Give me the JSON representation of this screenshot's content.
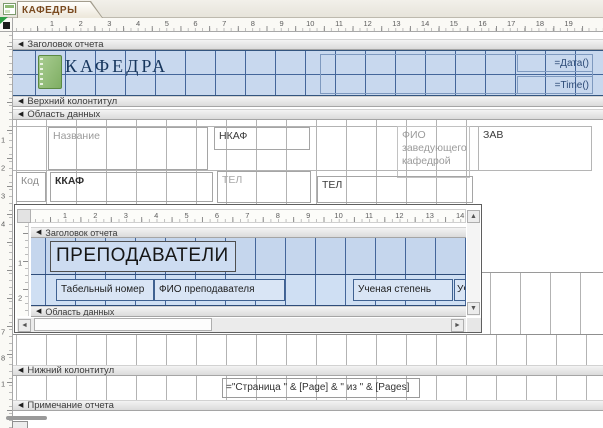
{
  "window": {
    "tab_label": "КАФЕДРЫ"
  },
  "rulers": {
    "main_h": [
      "1",
      "2",
      "3",
      "4",
      "5",
      "6",
      "7",
      "8",
      "9",
      "10",
      "11",
      "12",
      "13",
      "14",
      "15",
      "16",
      "17",
      "18",
      "19"
    ],
    "main_v_upper": [
      "1",
      "2",
      "3",
      "4"
    ],
    "main_v_lower": [
      "7",
      "8",
      "1"
    ],
    "sub_h": [
      "1",
      "2",
      "3",
      "4",
      "5",
      "6",
      "7",
      "8",
      "9",
      "10",
      "11",
      "12",
      "13",
      "14"
    ],
    "sub_v": [
      "1",
      "2"
    ]
  },
  "sections": {
    "report_header": "Заголовок отчета",
    "page_header": "Верхний колонтитул",
    "detail": "Область данных",
    "page_footer": "Нижний колонтитул",
    "report_footer": "Примечание отчета"
  },
  "report_header": {
    "title": "КАФЕДРА",
    "date_expr": "=Дата()",
    "time_expr": "=Time()"
  },
  "detail": {
    "label_name": "Название",
    "textbox_nkaf": "НКАФ",
    "label_fio": "ФИО заведующего кафедрой",
    "textbox_zav": "ЗАВ",
    "label_kod": "Код",
    "textbox_kkaf": "ККАФ",
    "label_tel": "ТЕЛ",
    "textbox_tel": "ТЕЛ"
  },
  "subreport": {
    "section_header": "Заголовок отчета",
    "section_detail": "Область данных",
    "title": "ПРЕПОДАВАТЕЛИ",
    "columns": [
      "Табельный номер",
      "ФИО преподавателя",
      "Ученая степень",
      "Уч"
    ]
  },
  "page_footer": {
    "page_expr": "=\"Страница \" & [Page] & \" из \" & [Pages]"
  },
  "colors": {
    "selection_blue": "#c8d8ee",
    "grid_blue": "#44669a",
    "tab_text_brown": "#7a4a1f",
    "title_navy": "#17365d",
    "icon_green": "#7fae63"
  }
}
